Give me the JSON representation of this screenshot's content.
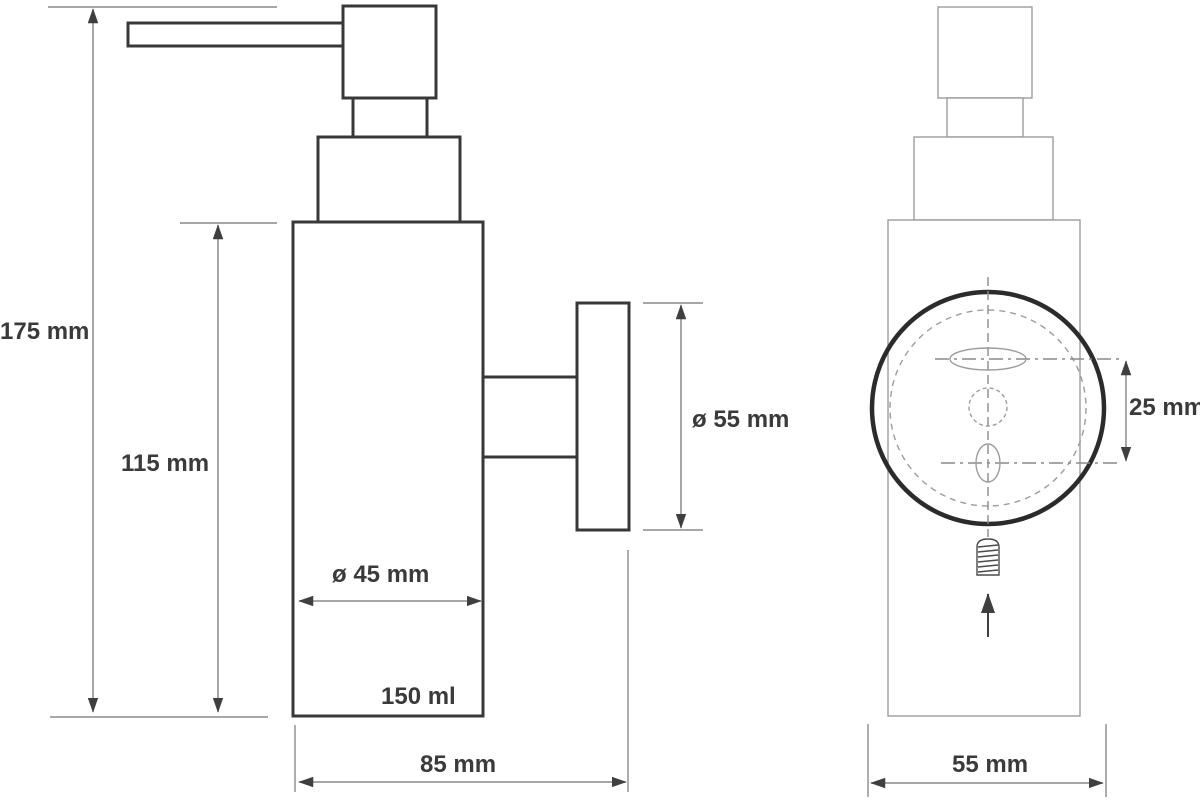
{
  "drawing": {
    "subject": "wall-mounted soap dispenser technical drawing",
    "views": {
      "side_view": "side view with pump, bottle body and wall flange",
      "front_view": "front view with mounting plate, keyholes and screw"
    },
    "dimensions": {
      "overall_height": "175 mm",
      "body_height": "115 mm",
      "body_diameter": "ø 45 mm",
      "capacity": "150 ml",
      "overall_depth": "85 mm",
      "flange_diameter": "ø 55 mm",
      "hole_spacing": "25 mm",
      "overall_width": "55 mm"
    },
    "colors": {
      "outline_dark": "#383838",
      "outline_light": "#9c9c9c",
      "dimension_line": "#8a8a8a",
      "text": "#3a3a3a",
      "background": "#ffffff"
    }
  }
}
